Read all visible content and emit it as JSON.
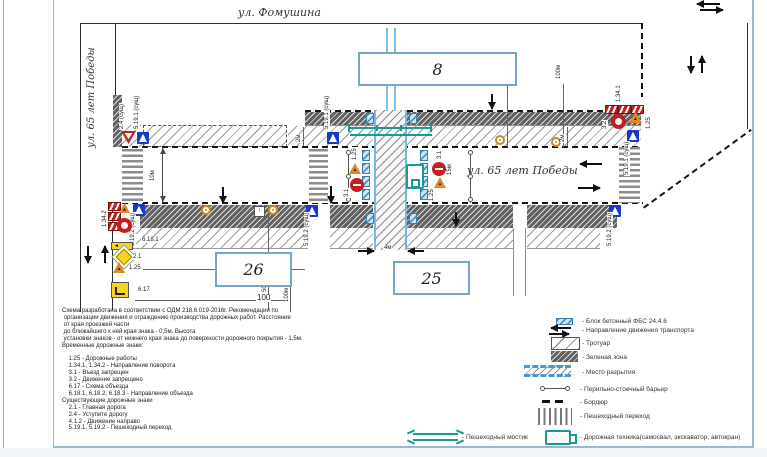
{
  "streets": {
    "fomushina": "ул. Фомушина",
    "pobedy": "ул. 65 лет Победы"
  },
  "buildings": {
    "b8": "8",
    "b26": "26",
    "b25": "25"
  },
  "dims": {
    "m10": "10м",
    "m2": "2м",
    "m4": "4м",
    "m15": "15м",
    "m50": "50м",
    "m100": "100м",
    "n50": "50",
    "n100": "100"
  },
  "signs": {
    "s24": "2.4 (сущ)",
    "s5191": "5.19.1 (сущ)",
    "s5192": "5.19.2 (сущ)",
    "s1341": "1.34.1",
    "s1342": "1.34.2",
    "s125": "1.25",
    "s31": "3.1",
    "s32": "3.2",
    "s21": "2.1",
    "s617": "6.17",
    "s6181": "6.18.1"
  },
  "notes": {
    "text": "Схема разработана в соответствии с ОДМ 218.6.019-2016г. Рекомендации по\n организации движения и ограждению производства дорожных работ. Расстояние\n от края проезжей части\n до ближайшего к ней края знака - 0,5м. Высота\n установки знаков - от нижнего края знака до поверхности дорожного покрытия - 1,5м.\nВременные дорожные знаки:\n\n    1.25 - Дорожные работы\n    1.34.1, 1.34.2 - Направление поворота\n    3.1 - Въезд запрещен\n    3.2 - Движение запрещено\n    6.17 - Схема объезда\n    6.18.1, 6.18.2, 6.18.3 - Направление объезда\nСуществующие дорожные знаки\n    2.1 - Главная дорога\n    2.4 - Уступите дорогу\n    4.1.2 - Движение направо\n    5.19.1, 5.19.2 - Пешеходный переход"
  },
  "legend": {
    "items": [
      {
        "label": "- Блок бетонный ФБС 24.4.6"
      },
      {
        "label": "- Направление движения транспорта"
      },
      {
        "label": "- Тротуар"
      },
      {
        "label": "- Зеленая зона"
      },
      {
        "label": "- Место разрытия"
      },
      {
        "label": "- Перильно-стоечный барьер"
      },
      {
        "label": "- Бордюр"
      },
      {
        "label": "- Пешеходный переход"
      },
      {
        "label": "- Пешеходный мостик"
      },
      {
        "label": "- Дорожная техника(самосвал, экскаватор, автокран)"
      }
    ]
  },
  "colors": {
    "frame": "#9ab9cf",
    "work_zone_blue": "#77b9e2",
    "machinery_teal": "#1b9a8f",
    "sign_blue": "#1739c4",
    "sign_red": "#c41e1e"
  }
}
